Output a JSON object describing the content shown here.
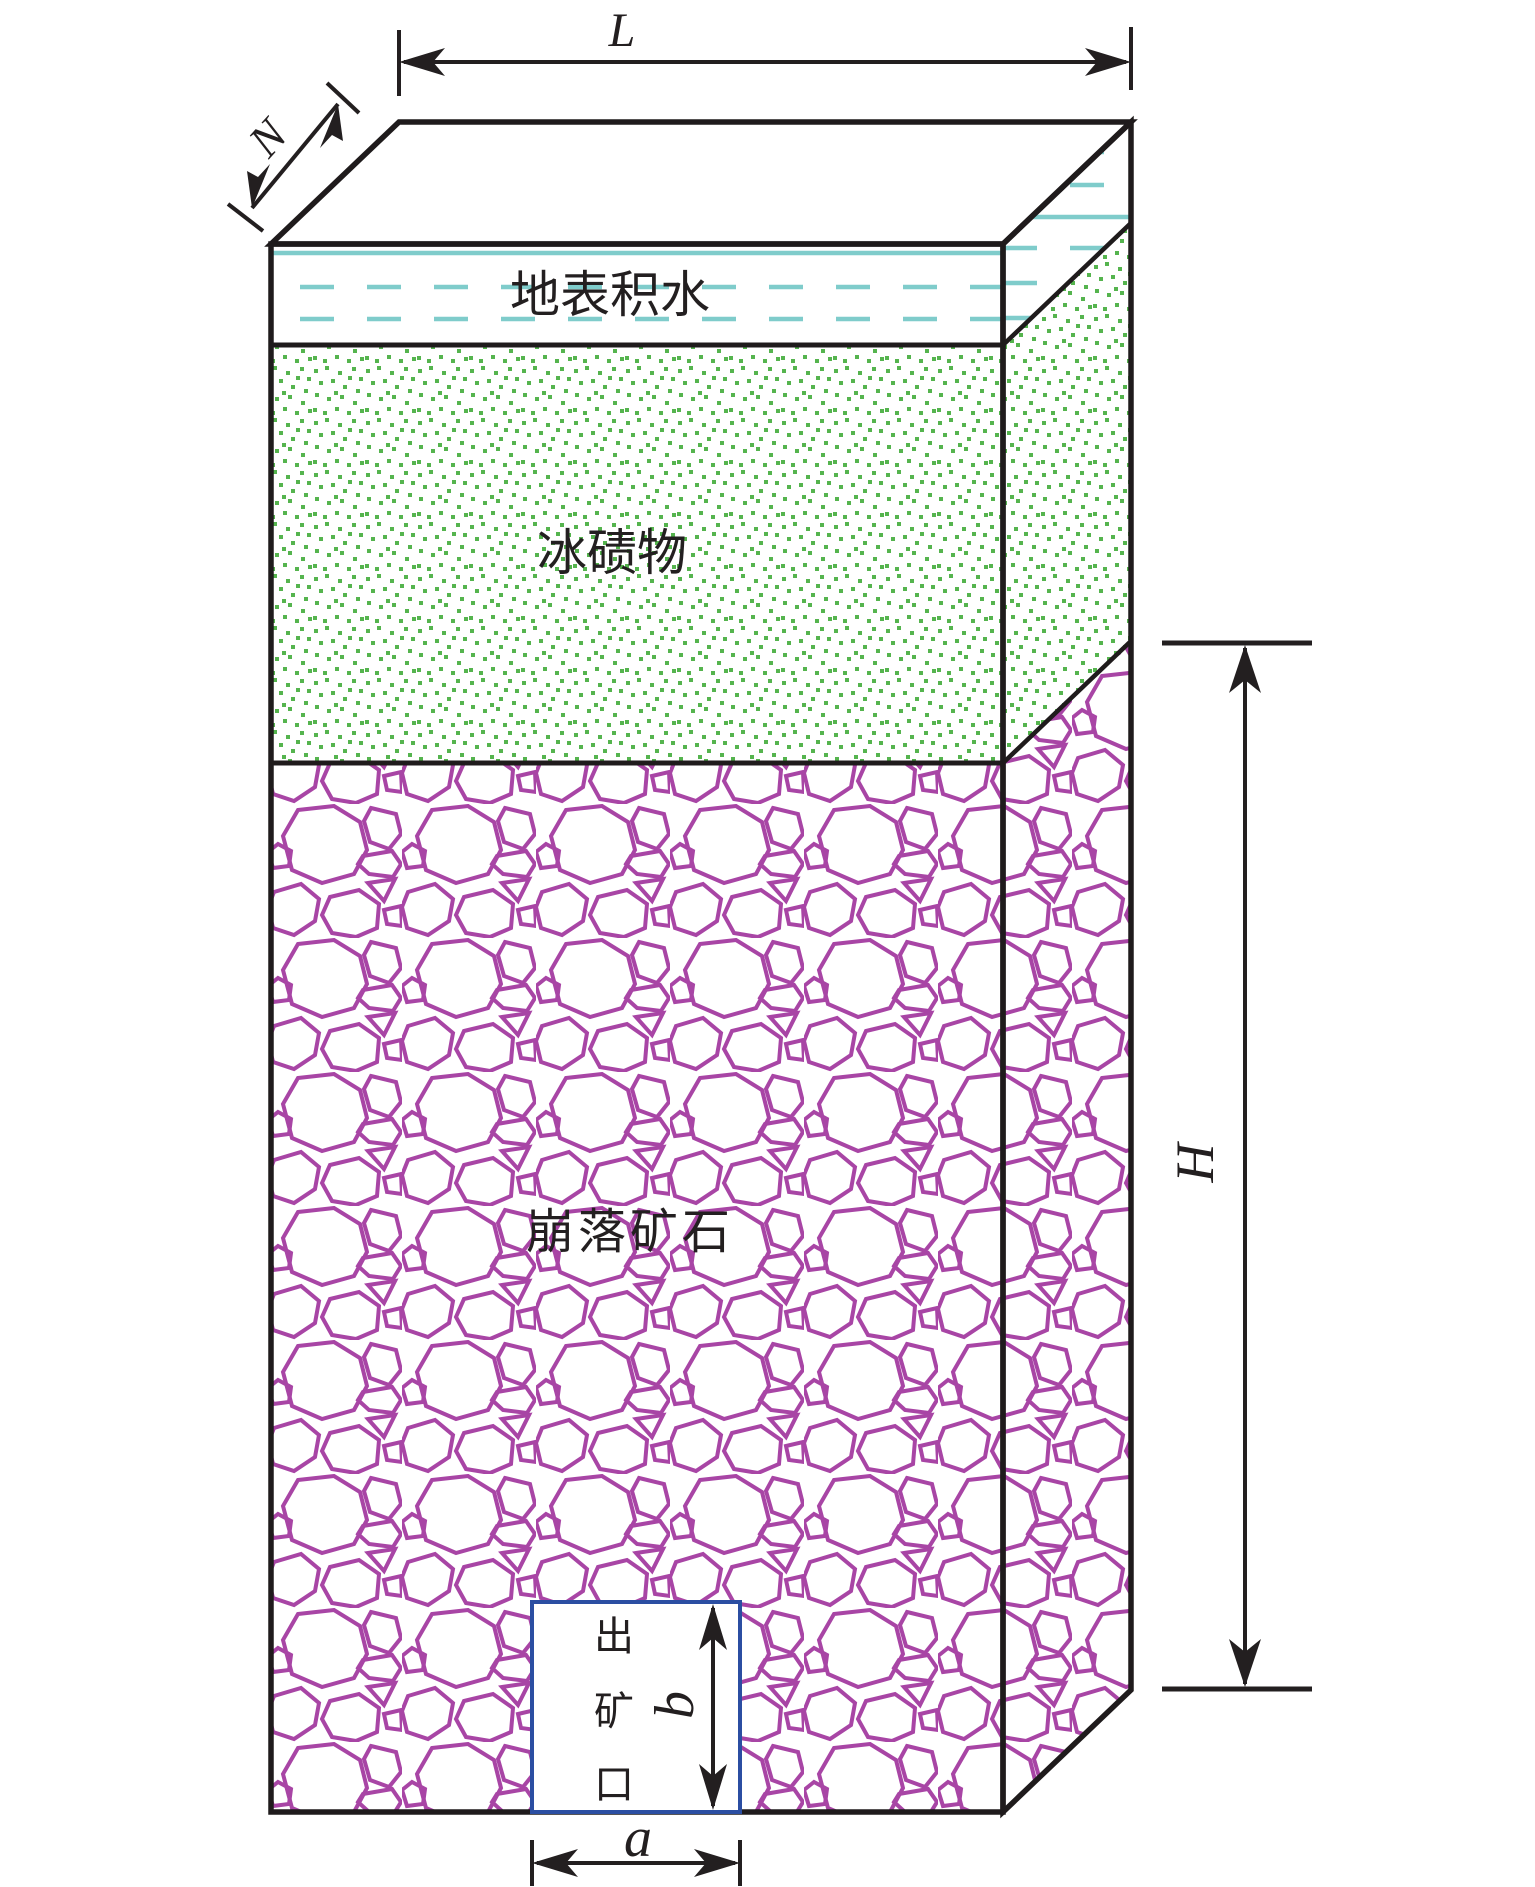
{
  "figure": {
    "type": "mining-block-3d-diagram",
    "dimension_labels": {
      "length": "L",
      "depth": "N",
      "height": "H",
      "outlet_width": "a",
      "outlet_height": "b"
    },
    "layers": [
      {
        "id": "surface-water",
        "label": "地表积水",
        "line_color": "#7fcccb"
      },
      {
        "id": "moraine",
        "label": "冰碛物",
        "dot_color": "#55b44e"
      },
      {
        "id": "caved-ore",
        "label": "崩落矿石",
        "line_color": "#a845a5"
      }
    ],
    "outlet": {
      "label": "出矿口",
      "chars": [
        "出",
        "矿",
        "口"
      ],
      "border_color": "#2b4ea2"
    },
    "ink_color": "#231f20"
  }
}
